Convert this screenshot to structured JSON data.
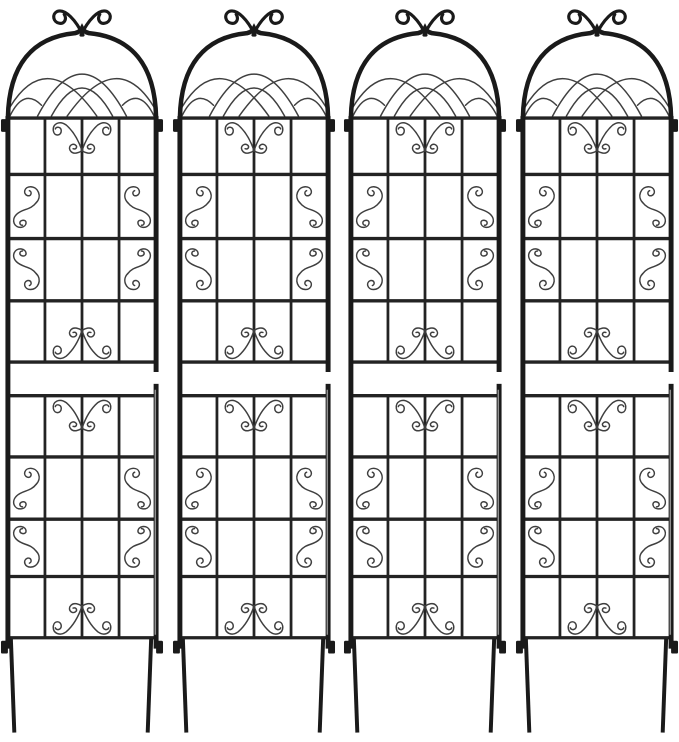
{
  "canvas": {
    "width": 679,
    "height": 742,
    "background": "#ffffff"
  },
  "product_image": {
    "description": "Set of 4 identical black metal garden trellis panels, each with an arched top crowned by a double-curl finial, a gothic crossing-curve lattice inside the arch, a 4-column welded grid body decorated with butterfly scrolls and corner S-scrolls, a plain horizontal band across the middle, side connector tabs, and two ground-stake legs",
    "panel_count": 4,
    "colors": {
      "frame": "#1a1a1a",
      "bar": "#232323",
      "wire": "#3f3f3f",
      "highlight": "#8f8f8f",
      "notch": "#ffffff",
      "background": "#ffffff"
    },
    "panel_structure": {
      "columns": 4,
      "grid_rows_upper": 4,
      "grid_rows_lower": 4,
      "middle_band": "plain horizontal band with no vertical bars",
      "ornaments": [
        "double-curl-finial",
        "gothic-lattice-arch",
        "butterfly-scroll",
        "corner-s-scroll"
      ],
      "legs_per_panel": 2,
      "connector_tabs_per_panel": 4
    },
    "panels": [
      {
        "id": "trellis-panel-1"
      },
      {
        "id": "trellis-panel-2"
      },
      {
        "id": "trellis-panel-3"
      },
      {
        "id": "trellis-panel-4"
      }
    ]
  }
}
